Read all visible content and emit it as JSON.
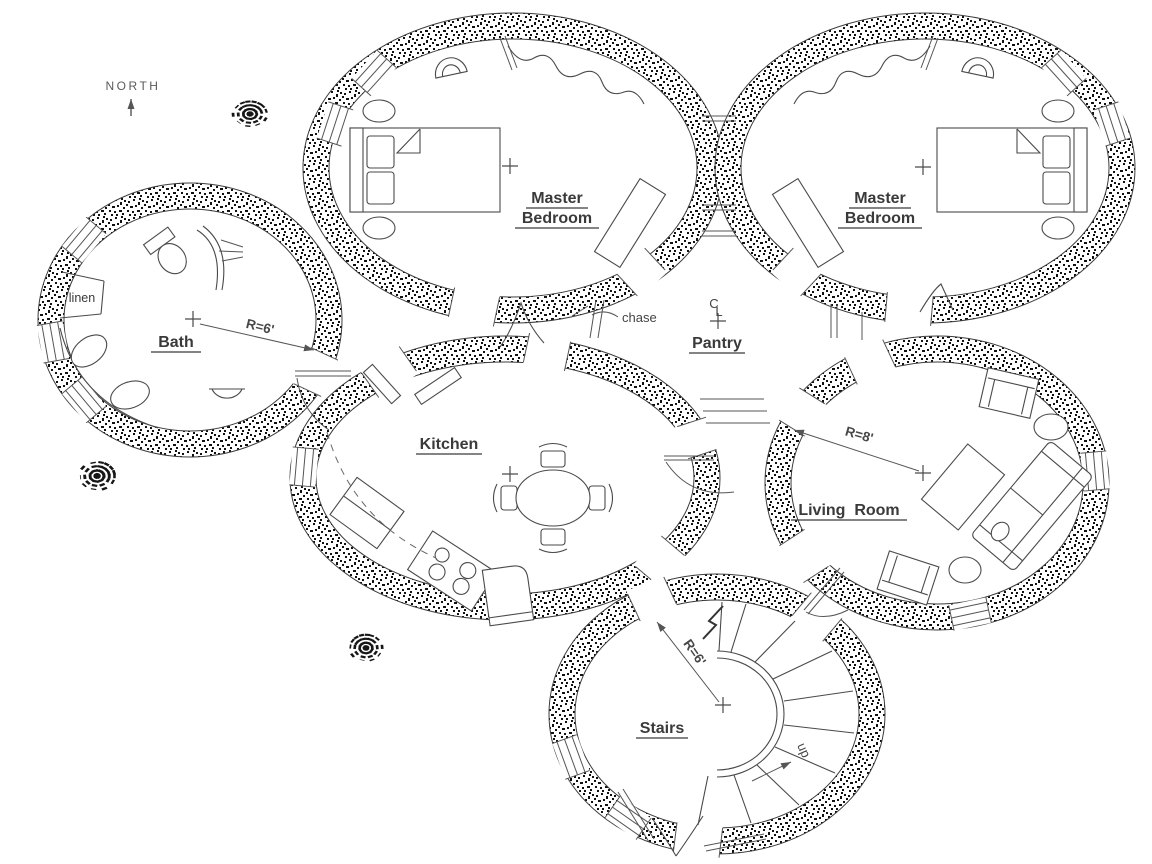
{
  "compass": {
    "north_label": "NORTH"
  },
  "rooms": {
    "bath": {
      "label": "Bath",
      "radius_dim": "R=6'"
    },
    "master_bedroom_left": {
      "label_line1": "Master",
      "label_line2": "Bedroom"
    },
    "master_bedroom_right": {
      "label_line1": "Master",
      "label_line2": "Bedroom"
    },
    "pantry": {
      "label": "Pantry",
      "centerline_c": "C",
      "centerline_l": "L"
    },
    "kitchen": {
      "label": "Kitchen"
    },
    "living_room": {
      "label": "Living  Room",
      "radius_dim": "R=8'"
    },
    "stairs": {
      "label": "Stairs",
      "radius_dim": "R=6'",
      "direction_label": "up"
    }
  },
  "annotations": {
    "linen": "linen",
    "chase": "chase"
  },
  "icons": {
    "north_arrow": "north-arrow-icon",
    "tree": "tree-icon",
    "bed": "bed-icon",
    "nightstand": "side-table-icon",
    "closet_rod": "closet-rod-icon",
    "alcove": "alcove-icon",
    "dresser": "dresser-icon",
    "toilet": "toilet-icon",
    "vanity_sinks": "vanity-sinks-icon",
    "wall_sink": "sink-icon",
    "refrigerator": "refrigerator-icon",
    "stove": "stove-icon",
    "counter": "counter-icon",
    "dining_table": "dining-table-icon",
    "chair": "chair-icon",
    "sofa": "sofa-icon",
    "armchair": "armchair-icon",
    "coffee_table": "coffee-table-icon",
    "spiral_stairs": "spiral-stairs-icon",
    "break_line": "break-line-icon",
    "window": "window-icon",
    "door_swing": "door-swing-icon",
    "center_mark": "center-mark-icon"
  },
  "colors": {
    "ink": "#3a3a3a",
    "stipple": "#111111",
    "paper": "#ffffff"
  }
}
